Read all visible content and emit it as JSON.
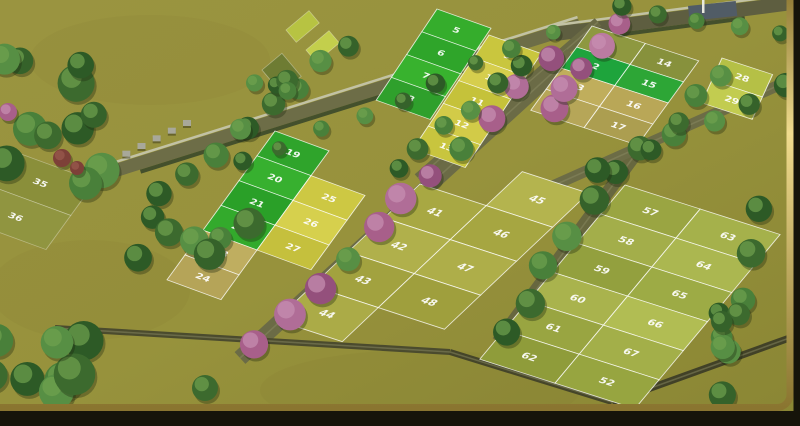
{
  "meta": {
    "description": "3D aerial render of a residential plotted land layout with numbered plots, tree-lined internal roads and a gold picture-frame border",
    "width": 800,
    "height": 426
  },
  "palette": {
    "field_top": "#9a9440",
    "field_mid": "#97923c",
    "field_bottom": "#8a8634",
    "frame_dark": "#16140a",
    "frame_gold_light": "#f0dc8e",
    "frame_gold_dark": "#8a7530",
    "plot_stroke": "rgba(255,255,255,0.78)",
    "road": "#6d6d47",
    "road_dark": "#5e5e40",
    "wall_light": "#c2c2a4",
    "hedge": "#44502c",
    "post": "#a8a89a",
    "structure": "#515c66",
    "pole": "#e9e9df",
    "tree_greens": [
      "#2d5a26",
      "#3c6a2e",
      "#49803a",
      "#578f44",
      "#35622a"
    ],
    "tree_green_hi": "#6fa14f",
    "tree_pinks": [
      "#a85f8a",
      "#b06d97",
      "#94507c",
      "#bb7ba1"
    ],
    "tree_pink_hi": "#c890b2",
    "tree_shadow": "rgba(30,40,15,0.35)",
    "red_bush": "#7d4038"
  },
  "blocks": [
    {
      "name": "block-left-strip",
      "matrix": [
        0.9,
        0.33,
        -0.45,
        0.62,
        10,
        150
      ],
      "stroke_opacity": 0.35,
      "num_opacity": 0.45,
      "cols": [
        {
          "x": 0,
          "w": 95,
          "cells": [
            {
              "y": 0,
              "h": 55,
              "color": "#8a8f3a",
              "num": "35"
            },
            {
              "y": 55,
              "h": 55,
              "color": "#909540",
              "num": "36"
            }
          ]
        }
      ]
    },
    {
      "name": "block-a-green-strip",
      "matrix": [
        0.9,
        0.32,
        -0.4,
        0.6,
        437,
        9
      ],
      "cols": [
        {
          "x": 0,
          "w": 60,
          "cells": [
            {
              "y": 0,
              "h": 38,
              "color": "#35ad2c",
              "num": "5"
            },
            {
              "y": 38,
              "h": 38,
              "color": "#2fa52a",
              "num": "6"
            },
            {
              "y": 76,
              "h": 38,
              "color": "#38b22e",
              "num": "7"
            },
            {
              "y": 114,
              "h": 38,
              "color": "#2fa02c",
              "num": "8"
            }
          ]
        }
      ]
    },
    {
      "name": "block-b-yellow-strip",
      "matrix": [
        0.9,
        0.32,
        -0.4,
        0.6,
        493,
        29
      ],
      "cols": [
        {
          "x": 0,
          "w": 58,
          "cells": [
            {
              "y": 10,
              "h": 38,
              "color": "#c9c63e",
              "num": "9"
            },
            {
              "y": 48,
              "h": 38,
              "color": "#d6ce4d",
              "num": "10"
            },
            {
              "y": 86,
              "h": 38,
              "color": "#c5c23a",
              "num": "11"
            },
            {
              "y": 124,
              "h": 38,
              "color": "#d2cb48",
              "num": "12"
            },
            {
              "y": 162,
              "h": 38,
              "color": "#c8c53e",
              "num": "13"
            }
          ]
        }
      ]
    },
    {
      "name": "block-c-topright",
      "matrix": [
        0.92,
        0.3,
        -0.45,
        0.62,
        592,
        26
      ],
      "cols": [
        {
          "x": 0,
          "w": 58,
          "cells": [
            {
              "y": 0,
              "h": 34,
              "color": "#8e9840",
              "num": "1"
            },
            {
              "y": 34,
              "h": 34,
              "color": "#1ea43c",
              "num": "2"
            },
            {
              "y": 68,
              "h": 34,
              "color": "#c0ae5c",
              "num": "3"
            },
            {
              "y": 102,
              "h": 34,
              "color": "#b6a658",
              "num": "4"
            }
          ]
        },
        {
          "x": 58,
          "w": 58,
          "cells": [
            {
              "y": 0,
              "h": 34,
              "color": "#87913c",
              "num": "14"
            },
            {
              "y": 34,
              "h": 34,
              "color": "#2da636",
              "num": "15"
            },
            {
              "y": 68,
              "h": 34,
              "color": "#b9a757",
              "num": "16"
            },
            {
              "y": 102,
              "h": 34,
              "color": "#ac9e50",
              "num": "17"
            }
          ]
        }
      ]
    },
    {
      "name": "block-c2-far-right",
      "matrix": [
        0.92,
        0.3,
        -0.3,
        0.66,
        722,
        58
      ],
      "cols": [
        {
          "x": 0,
          "w": 55,
          "cells": [
            {
              "y": 0,
              "h": 34,
              "color": "#b5c046",
              "num": "28"
            },
            {
              "y": 34,
              "h": 34,
              "color": "#c2cc50",
              "num": "29"
            }
          ]
        }
      ]
    },
    {
      "name": "block-d-midleft",
      "matrix": [
        0.9,
        0.33,
        -0.45,
        0.62,
        275,
        131
      ],
      "cols": [
        {
          "x": 0,
          "w": 60,
          "cells": [
            {
              "y": 0,
              "h": 40,
              "color": "#2fa42b",
              "num": "19"
            },
            {
              "y": 40,
              "h": 40,
              "color": "#37b02f",
              "num": "20"
            },
            {
              "y": 80,
              "h": 40,
              "color": "#2aa028",
              "num": "21"
            },
            {
              "y": 120,
              "h": 40,
              "color": "#33aa2c",
              "num": "22"
            },
            {
              "y": 160,
              "h": 40,
              "color": "#bfae60",
              "num": "23"
            },
            {
              "y": 200,
              "h": 40,
              "color": "#b5a458",
              "num": "24"
            }
          ]
        },
        {
          "x": 60,
          "w": 60,
          "cells": [
            {
              "y": 40,
              "h": 40,
              "color": "#cdc843",
              "num": "25"
            },
            {
              "y": 80,
              "h": 40,
              "color": "#d6d04d",
              "num": "26"
            },
            {
              "y": 120,
              "h": 40,
              "color": "#c5c03d",
              "num": "27"
            }
          ]
        }
      ]
    },
    {
      "name": "block-f-center",
      "matrix": [
        0.92,
        0.3,
        -0.72,
        0.68,
        420,
        184
      ],
      "cols": [
        {
          "x": 0,
          "w": 72,
          "cells": [
            {
              "y": 0,
              "h": 50,
              "color": "#a8a843",
              "num": "41"
            },
            {
              "y": 50,
              "h": 50,
              "color": "#b0b04b",
              "num": "42"
            },
            {
              "y": 100,
              "h": 50,
              "color": "#a2a23f",
              "num": "43"
            },
            {
              "y": 150,
              "h": 50,
              "color": "#abab47",
              "num": "44"
            }
          ]
        },
        {
          "x": 72,
          "w": 72,
          "cells": [
            {
              "y": -50,
              "h": 50,
              "color": "#b4b44e",
              "num": "45"
            },
            {
              "y": 0,
              "h": 50,
              "color": "#a6a641",
              "num": "46"
            },
            {
              "y": 50,
              "h": 50,
              "color": "#aeae49",
              "num": "47"
            },
            {
              "y": 100,
              "h": 50,
              "color": "#9f9f3d",
              "num": "48"
            }
          ]
        }
      ]
    },
    {
      "name": "block-g-right",
      "matrix": [
        0.94,
        0.3,
        -0.55,
        0.66,
        625,
        185
      ],
      "cols": [
        {
          "x": 0,
          "w": 80,
          "cells": [
            {
              "y": 0,
              "h": 44,
              "color": "#9aa542",
              "num": "57"
            },
            {
              "y": 44,
              "h": 44,
              "color": "#a3ae4a",
              "num": "58"
            },
            {
              "y": 88,
              "h": 44,
              "color": "#93a03e",
              "num": "59"
            },
            {
              "y": 132,
              "h": 44,
              "color": "#a9b34d",
              "num": "60"
            },
            {
              "y": 176,
              "h": 44,
              "color": "#99a541",
              "num": "61"
            },
            {
              "y": 220,
              "h": 44,
              "color": "#8f9c3a",
              "num": "62"
            }
          ]
        },
        {
          "x": 80,
          "w": 85,
          "cells": [
            {
              "y": 0,
              "h": 44,
              "color": "#a5b14b",
              "num": "63"
            },
            {
              "y": 44,
              "h": 44,
              "color": "#abb750",
              "num": "64"
            },
            {
              "y": 88,
              "h": 44,
              "color": "#9dab45",
              "num": "65"
            },
            {
              "y": 132,
              "h": 44,
              "color": "#b1bd53",
              "num": "66"
            },
            {
              "y": 176,
              "h": 44,
              "color": "#a3af49",
              "num": "67"
            },
            {
              "y": 220,
              "h": 44,
              "color": "#97a540",
              "num": "52"
            }
          ]
        }
      ]
    }
  ],
  "roads": [
    {
      "name": "boundary-road-top",
      "x1": 60,
      "y1": 188,
      "x2": 580,
      "y2": 25,
      "w": 13,
      "color": "#6d6d47",
      "wall": true
    },
    {
      "name": "boundary-road-top-right",
      "x1": 555,
      "y1": 34,
      "x2": 800,
      "y2": 2,
      "w": 14,
      "color": "#5e5e40",
      "wall": true
    },
    {
      "name": "road-between-b-c",
      "x1": 418,
      "y1": 178,
      "x2": 598,
      "y2": 22,
      "w": 10,
      "color": "#6a6a44",
      "wall": false
    },
    {
      "name": "central-avenue",
      "x1": 240,
      "y1": 358,
      "x2": 572,
      "y2": 55,
      "w": 16,
      "color": "#6b6b46",
      "wall": false
    },
    {
      "name": "road-f-g",
      "x1": 498,
      "y1": 342,
      "x2": 640,
      "y2": 148,
      "w": 13,
      "color": "#67673f",
      "wall": false
    },
    {
      "name": "road-g-top",
      "x1": 548,
      "y1": 188,
      "x2": 795,
      "y2": 78,
      "w": 11,
      "color": "#6c6c46",
      "wall": false
    },
    {
      "name": "site-edge-left",
      "x1": 55,
      "y1": 328,
      "x2": 450,
      "y2": 352,
      "w": 6,
      "color": "#4b4b2e",
      "wall": false
    },
    {
      "name": "site-edge-mid",
      "x1": 450,
      "y1": 352,
      "x2": 612,
      "y2": 402,
      "w": 6,
      "color": "#454529",
      "wall": false
    },
    {
      "name": "site-edge-right",
      "x1": 612,
      "y1": 402,
      "x2": 795,
      "y2": 336,
      "w": 7,
      "color": "#414127",
      "wall": false
    }
  ],
  "tree_rows": [
    {
      "name": "avenue-flowering-trees",
      "x1": 258,
      "y1": 342,
      "x2": 550,
      "y2": 62,
      "n": 11,
      "rmin": 11,
      "rmax": 16,
      "type": "mix"
    },
    {
      "name": "flowering-cluster-upper",
      "x1": 552,
      "y1": 112,
      "x2": 618,
      "y2": 24,
      "n": 5,
      "rmin": 10,
      "rmax": 14,
      "type": "pink"
    },
    {
      "name": "trees-b-west",
      "x1": 398,
      "y1": 172,
      "x2": 520,
      "y2": 64,
      "n": 6,
      "rmin": 8,
      "rmax": 11,
      "type": "green"
    },
    {
      "name": "trees-f-g-road",
      "x1": 505,
      "y1": 335,
      "x2": 612,
      "y2": 168,
      "n": 6,
      "rmin": 12,
      "rmax": 15,
      "type": "green"
    },
    {
      "name": "trees-g-top-road",
      "x1": 602,
      "y1": 168,
      "x2": 782,
      "y2": 88,
      "n": 6,
      "rmin": 10,
      "rmax": 13,
      "type": "green"
    },
    {
      "name": "trees-right-edge",
      "x1": 763,
      "y1": 208,
      "x2": 722,
      "y2": 395,
      "n": 5,
      "rmin": 12,
      "rmax": 15,
      "type": "green"
    },
    {
      "name": "trees-top-road",
      "x1": 245,
      "y1": 162,
      "x2": 555,
      "y2": 32,
      "n": 9,
      "rmin": 7,
      "rmax": 10,
      "type": "green"
    },
    {
      "name": "trees-top-right-corner",
      "x1": 618,
      "y1": 10,
      "x2": 778,
      "y2": 34,
      "n": 5,
      "rmin": 8,
      "rmax": 11,
      "type": "green"
    },
    {
      "name": "trees-c-c2-gap",
      "x1": 655,
      "y1": 148,
      "x2": 722,
      "y2": 74,
      "n": 4,
      "rmin": 10,
      "rmax": 12,
      "type": "green"
    },
    {
      "name": "trees-d-top",
      "x1": 250,
      "y1": 128,
      "x2": 350,
      "y2": 44,
      "n": 5,
      "rmin": 9,
      "rmax": 12,
      "type": "green"
    },
    {
      "name": "trees-d-west",
      "x1": 160,
      "y1": 195,
      "x2": 240,
      "y2": 130,
      "n": 4,
      "rmin": 10,
      "rmax": 13,
      "type": "green"
    }
  ],
  "tree_clusters": [
    {
      "name": "grove-left-edge",
      "cx": 50,
      "cy": 125,
      "n": 11,
      "sx": 58,
      "sy": 75,
      "rmin": 12,
      "rmax": 19
    },
    {
      "name": "grove-bottom-left",
      "cx": 48,
      "cy": 382,
      "n": 9,
      "sx": 60,
      "sy": 48,
      "rmin": 13,
      "rmax": 21
    },
    {
      "name": "grove-mid-left",
      "cx": 196,
      "cy": 232,
      "n": 7,
      "sx": 62,
      "sy": 26,
      "rmin": 11,
      "rmax": 16
    },
    {
      "name": "grove-g-bottom",
      "cx": 705,
      "cy": 338,
      "n": 5,
      "sx": 34,
      "sy": 30,
      "rmin": 10,
      "rmax": 14
    },
    {
      "name": "grove-above-a",
      "cx": 268,
      "cy": 88,
      "n": 4,
      "sx": 26,
      "sy": 22,
      "rmin": 8,
      "rmax": 12
    }
  ],
  "single_trees": [
    {
      "name": "lone-tree",
      "x": 205,
      "y": 388,
      "r": 13,
      "color": "#3c6a2e",
      "hi": "#6fa14f"
    },
    {
      "name": "red-bush-1",
      "x": 62,
      "y": 158,
      "r": 9,
      "color": "#7d4038",
      "hi": "#9a5a4e"
    },
    {
      "name": "red-bush-2",
      "x": 77,
      "y": 168,
      "r": 7,
      "color": "#7d4038",
      "hi": "#9a5a4e"
    },
    {
      "name": "pink-bush-left-edge",
      "x": 8,
      "y": 112,
      "r": 9,
      "color": "#a85f8a",
      "hi": "#c890b2"
    }
  ],
  "patches": [
    {
      "name": "bright-plot-patch-1",
      "x": 286,
      "y": 30,
      "w": 30,
      "h": 16,
      "rot": -40,
      "color": "#b7c342"
    },
    {
      "name": "bright-plot-patch-2",
      "x": 306,
      "y": 50,
      "w": 30,
      "h": 16,
      "rot": -40,
      "color": "#c3cf4c"
    },
    {
      "name": "hedge-patch",
      "x": 262,
      "y": 70,
      "w": 26,
      "h": 30,
      "rot": -40,
      "color": "#6e7c33"
    }
  ],
  "posts": {
    "name": "compound-wall-posts",
    "x1": 92,
    "y1": 166,
    "x2": 183,
    "y2": 120,
    "n": 7,
    "w": 8,
    "h": 6
  },
  "structure": {
    "name": "site-shed",
    "x": 688,
    "y": 6,
    "w": 48,
    "h": 15,
    "rot": -6
  },
  "pole": {
    "name": "flag-pole",
    "x": 702,
    "y": 0,
    "w": 2.5,
    "h": 13
  },
  "mottles": [
    {
      "cx": 150,
      "cy": 60,
      "rx": 120,
      "ry": 45
    },
    {
      "cx": 420,
      "cy": 390,
      "rx": 160,
      "ry": 40
    },
    {
      "cx": 90,
      "cy": 290,
      "rx": 100,
      "ry": 50
    }
  ]
}
